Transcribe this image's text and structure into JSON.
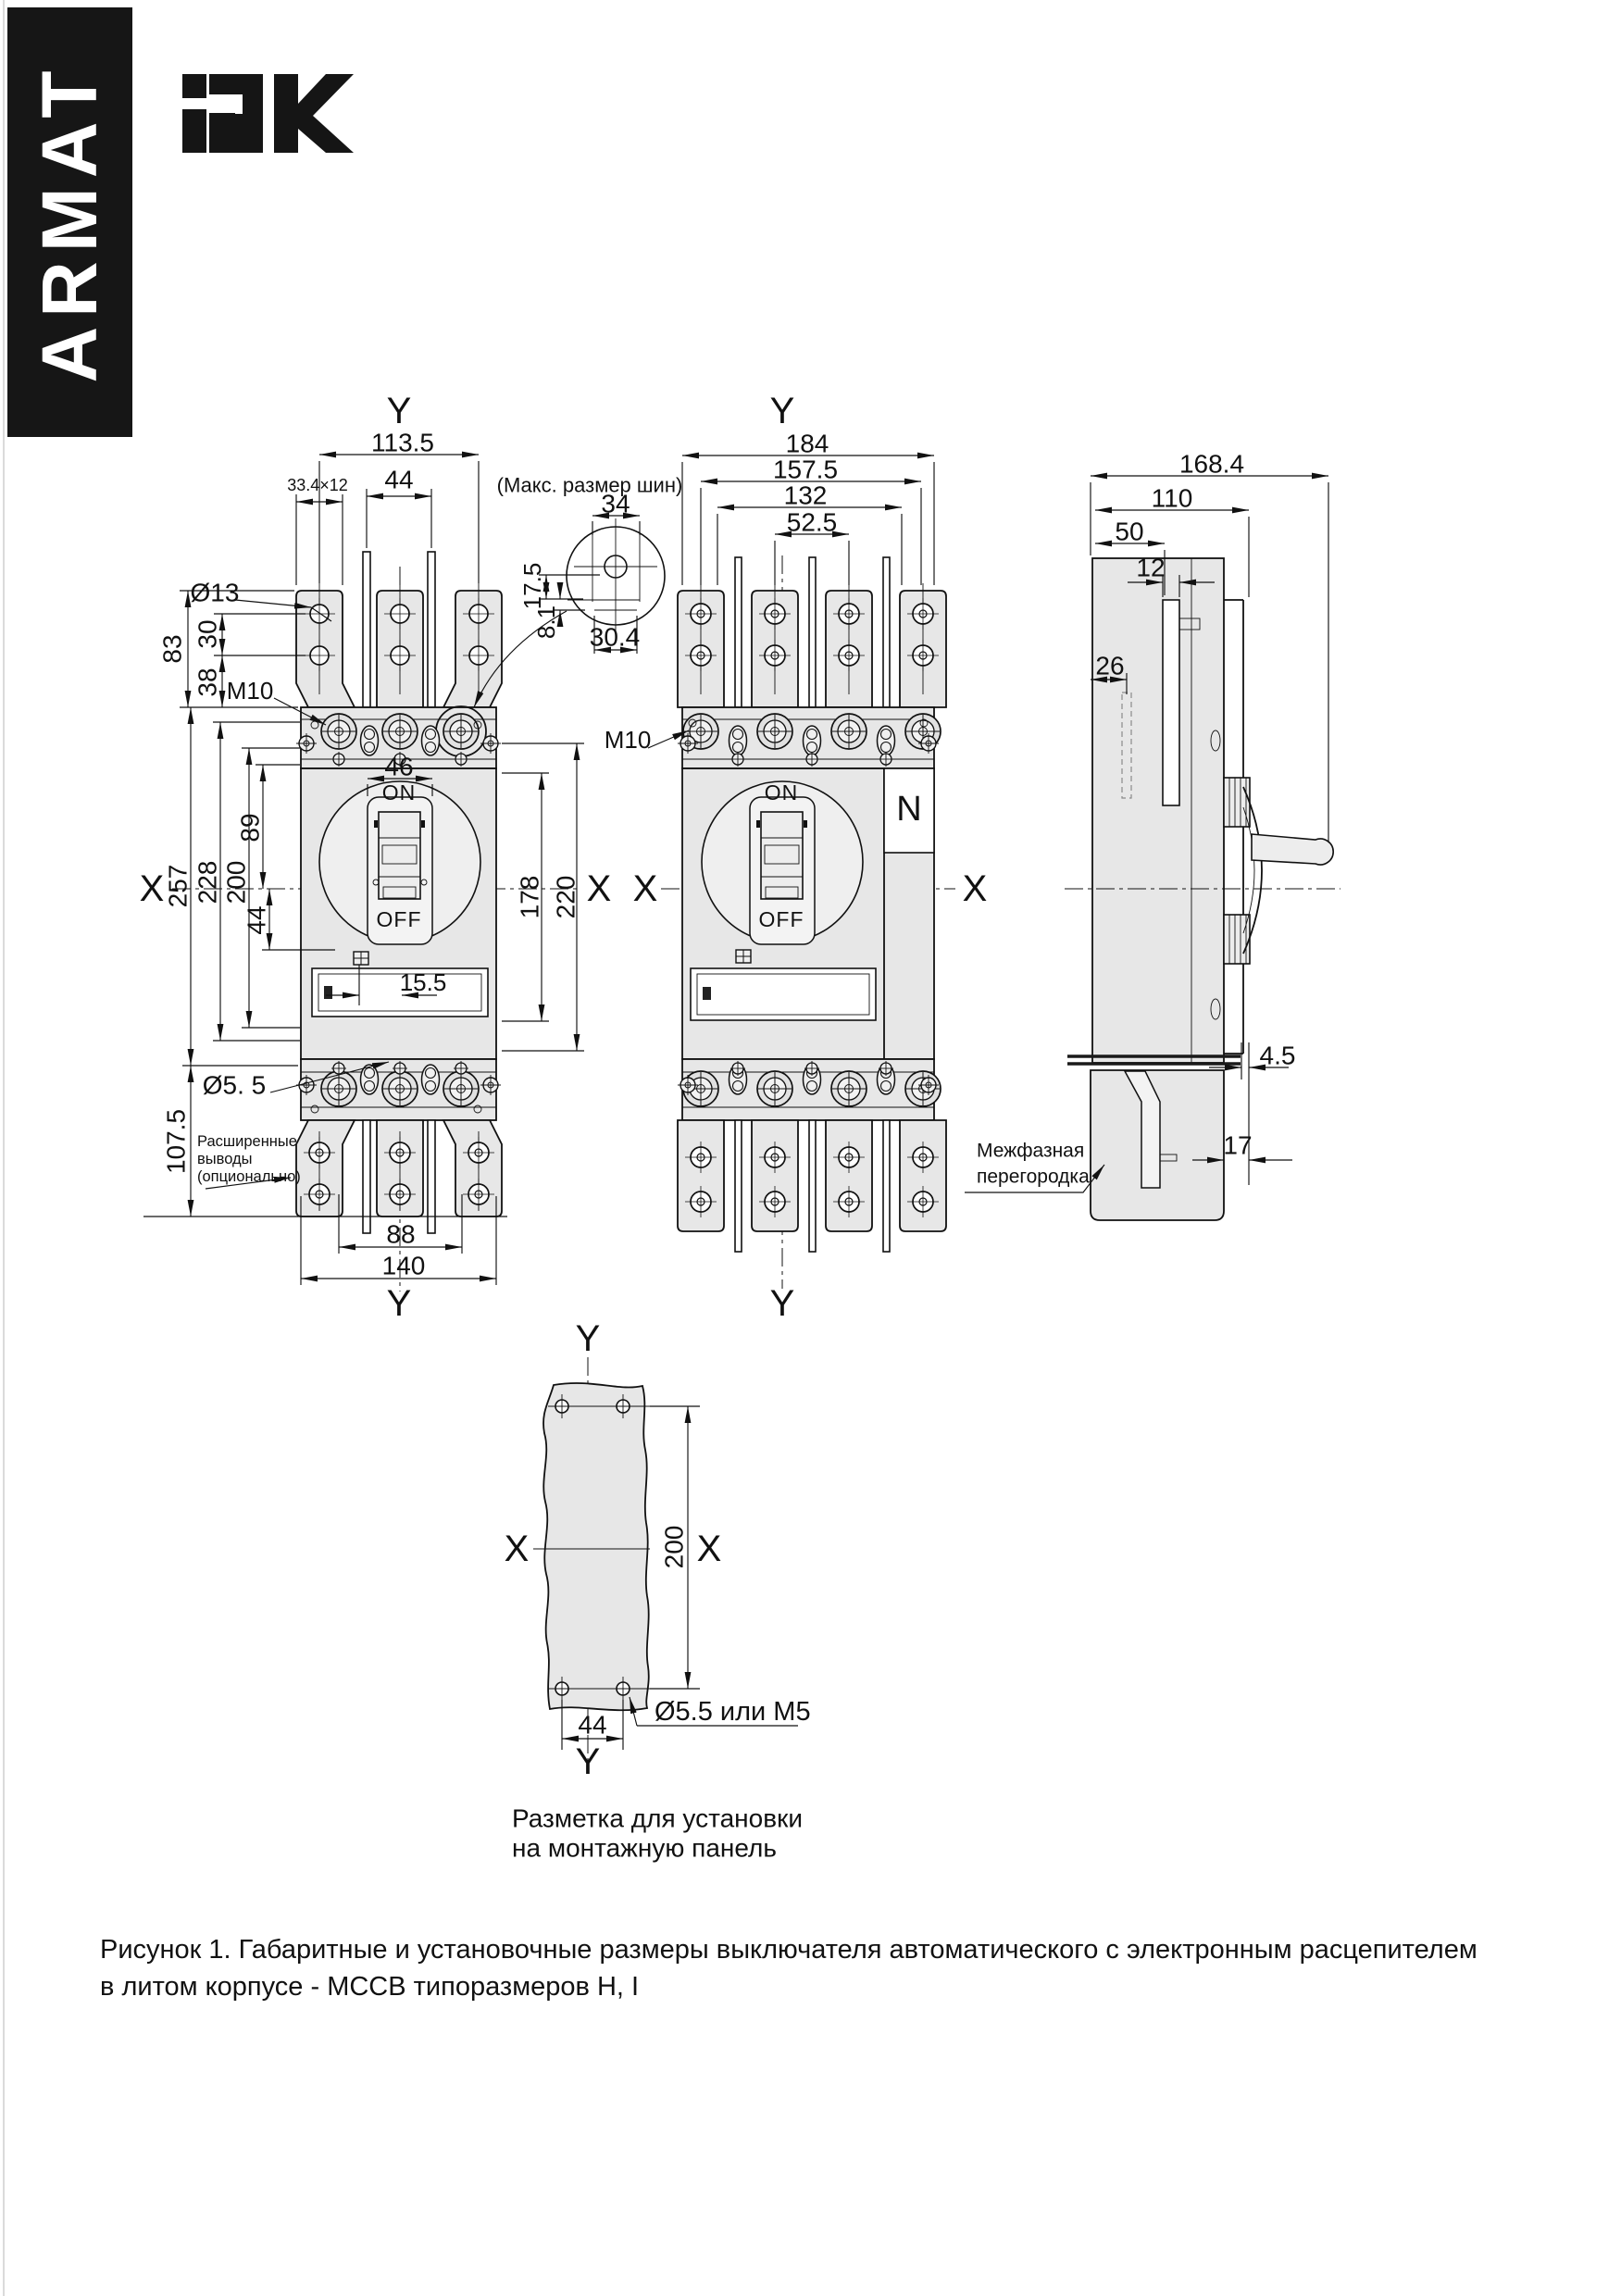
{
  "banner": {
    "text": "ARMAT"
  },
  "logo": {
    "text": "IEK"
  },
  "axes": {
    "x": "X",
    "y": "Y"
  },
  "breaker": {
    "on": "ON",
    "off": "OFF",
    "neutral": "N"
  },
  "view1": {
    "dim_width_top": "113.5",
    "dim_slot": "33.4×12",
    "dim_pitch_top": "44",
    "dim_lug_hole": "Ø13",
    "dim_83": "83",
    "dim_30": "30",
    "dim_38": "38",
    "thread": "M10",
    "dim_257": "257",
    "dim_228": "228",
    "dim_200": "200",
    "dim_89": "89",
    "dim_44": "44",
    "dim_46": "46",
    "dim_178": "178",
    "dim_220": "220",
    "dim_155": "15.5",
    "dim_hole55": "Ø5. 5",
    "dim_1075": "107.5",
    "dim_88": "88",
    "dim_140": "140",
    "note_ext1": "Расширенные",
    "note_ext2": "выводы",
    "note_ext3": "(опционально)"
  },
  "bus_detail": {
    "title": "(Макс. размер шин)",
    "dim_34": "34",
    "dim_175": "17.5",
    "dim_81": "8.1",
    "dim_304": "30.4"
  },
  "view2": {
    "dim_184": "184",
    "dim_1575": "157.5",
    "dim_132": "132",
    "dim_525": "52.5",
    "thread": "M10"
  },
  "view3": {
    "dim_1684": "168.4",
    "dim_110": "110",
    "dim_50": "50",
    "dim_12": "12",
    "dim_26": "26",
    "dim_45": "4.5",
    "dim_17": "17",
    "note_barrier1": "Межфазная",
    "note_barrier2": "перегородка"
  },
  "panel": {
    "dim_200": "200",
    "dim_44": "44",
    "hole_label": "Ø5.5 или M5",
    "caption1": "Разметка для установки",
    "caption2": "на монтажную панель"
  },
  "figure": {
    "caption1": "Рисунок 1. Габаритные и установочные размеры выключателя автоматического с электронным расцепителем",
    "caption2": "в литом корпусе - MCCB типоразмеров H, I"
  }
}
